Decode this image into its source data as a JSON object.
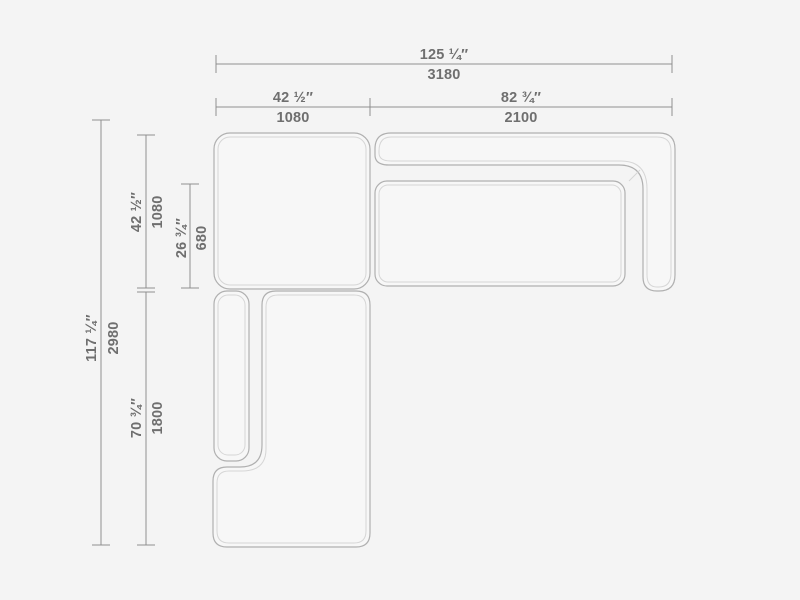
{
  "colors": {
    "background": "#f4f4f4",
    "module_fill": "#f7f7f7",
    "outline": "#b0b0b0",
    "piping": "#d6d6d6",
    "dimension_line": "#8f8f8f",
    "label_text": "#6f6f6f"
  },
  "drawing": {
    "kind": "sectional-sofa-top-view-dimension-diagram",
    "dims": {
      "total_width": {
        "in": "125 ¼″",
        "mm": "3180"
      },
      "left_section_width": {
        "in": "42 ½″",
        "mm": "1080"
      },
      "right_section_width": {
        "in": "82 ¾″",
        "mm": "2100"
      },
      "total_depth": {
        "in": "117 ¼″",
        "mm": "2980"
      },
      "corner_depth": {
        "in": "42 ½″",
        "mm": "1080"
      },
      "seat_depth": {
        "in": "26 ¾″",
        "mm": "680"
      },
      "chaise_length": {
        "in": "70 ¾″",
        "mm": "1800"
      }
    }
  }
}
